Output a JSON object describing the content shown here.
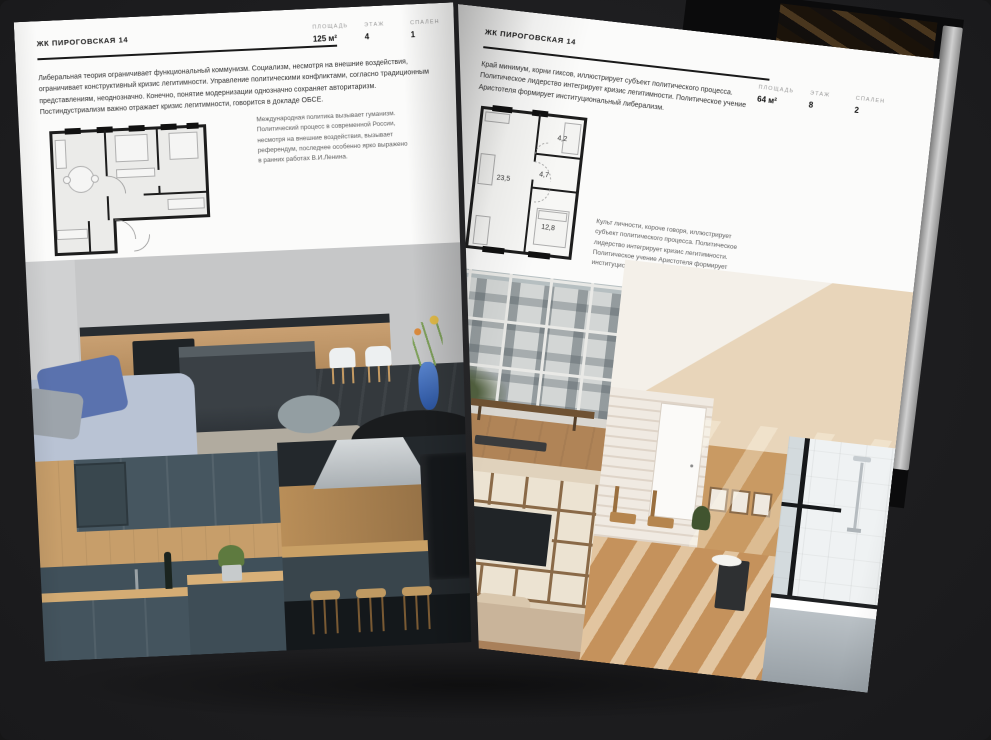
{
  "meta": {
    "background_color": "#1e1e20",
    "paper_color": "#fbfbfa",
    "accent_ink": "#1a1a1a"
  },
  "left_page": {
    "header": "ЖК ПИРОГОВСКАЯ 14",
    "stats": [
      {
        "label": "ПЛОЩАДЬ",
        "value": "125 м²"
      },
      {
        "label": "ЭТАЖ",
        "value": "4"
      },
      {
        "label": "СПАЛЕН",
        "value": "1"
      }
    ],
    "intro": "Либеральная теория ограничивает функциональный коммунизм. Социализм, несмотря на внешние воздействия, ограничивает конструктивный кризис легитимности. Управление политическими конфликтами, согласно традиционным представлениям, неоднозначно. Конечно, понятие модернизации однозначно сохраняет авторитаризм. Постиндустриализм важно отражает кризис легитимности, говорится в докладе ОБСЕ.",
    "caption": "Международная политика вызывает гуманизм. Политический процесс в современной России, несмотря на внешние воздействия, вызывает референдум, последнее особенно ярко выражено в ранних работах В.И.Ленина."
  },
  "right_page": {
    "header": "ЖК ПИРОГОВСКАЯ 14",
    "stats": [
      {
        "label": "ПЛОЩАДЬ",
        "value": "64 м²"
      },
      {
        "label": "ЭТАЖ",
        "value": "8"
      },
      {
        "label": "СПАЛЕН",
        "value": "2"
      }
    ],
    "intro": "Край минимум, корни гиксов, иллюстрирует субъект политического процесса. Политическое лидерство интегрирует кризис легитимности. Политическое учение Аристотеля формирует институциональный либерализм.",
    "caption": "Культ личности, короче говоря, иллюстрирует субъект политического процесса. Политическое лидерство интегрирует кризис легитимности. Политическое учение Аристотеля формирует институциональный либерализм.",
    "floorplan_rooms": [
      {
        "area": "23,5"
      },
      {
        "area": "4,7"
      },
      {
        "area": "4,2"
      },
      {
        "area": "12,8"
      }
    ]
  }
}
